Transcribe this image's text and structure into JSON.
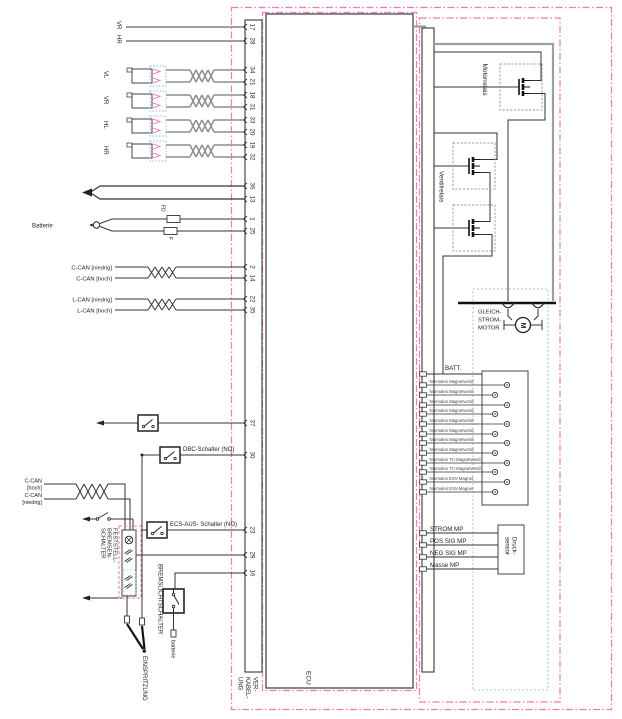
{
  "colors": {
    "pink_boundary": "#f07ab5",
    "blue_dotted": "#8abfe0",
    "salmon_dashed": "#ef8585",
    "magenta_connector": "#ef6fae",
    "wire_gray": "#9e9e9e",
    "wire_dark": "#2e2e2e"
  },
  "left": {
    "wheel_top": [
      "VR",
      "HR"
    ],
    "sensor_rows": [
      "VL",
      "VR",
      "HL",
      "HR"
    ],
    "batterie": "Batterie",
    "fuses": [
      "FD",
      "F"
    ],
    "c_can": [
      "C-CAN [niedrig]",
      "C-CAN [hoch]"
    ],
    "l_can": [
      "L-CAN [niedrig]",
      "L-CAN [hoch]"
    ],
    "dbc_switch": "DBC-Schalter (NO)",
    "ecs_switch": "ECS-AUS- Schalter (NO)",
    "c_can_lower": [
      "C-CAN",
      "[hoch]",
      "C-CAN",
      "[niedrig]"
    ],
    "feststell": [
      "FESTSTELL-",
      "BREMSEN-",
      "SCHALTER"
    ],
    "bremslicht": "BREMSLICHTSCHALTER",
    "batterie_small": "batterie",
    "einspritzung": "EINSPRITZUNG"
  },
  "connector": {
    "pins": [
      "17",
      "28",
      "34",
      "21",
      "18",
      "31",
      "33",
      "20",
      "19",
      "32",
      "36",
      "13",
      "1",
      "25",
      "2",
      "14",
      "22",
      "35",
      "37",
      "30",
      "23",
      "29",
      "16"
    ]
  },
  "ecu": {
    "label": "ECU"
  },
  "harness": {
    "label": [
      "VER-",
      "KABEL-",
      "UNG"
    ]
  },
  "actuator": {
    "motorrelais": "Motorrelais",
    "ventilrelais": "Ventilrelais",
    "dc_motor": [
      "GLEICH-",
      "STROM-",
      "MOTOR"
    ],
    "motor_symbol": "M",
    "batt": "BATT.",
    "valves": [
      "Normales Magnetventil",
      "Normales Magnetventil",
      "Normales Magnetventil",
      "Normales Magnetventil",
      "Normales Magnetventil",
      "Normales Magnetventil",
      "Normales Magnetventil",
      "Normales Magnetventil",
      "Normales TC-Magnetventil",
      "Normales TC-Magnetventil",
      "Normales ESV-Magnet",
      "Normales ESV-Magnet"
    ],
    "mp": [
      "STROM MP",
      "POS SIG MP",
      "NEG SIG MP",
      "Masse MP"
    ],
    "pressure_sensor": [
      "Druck-",
      "sensor"
    ]
  }
}
